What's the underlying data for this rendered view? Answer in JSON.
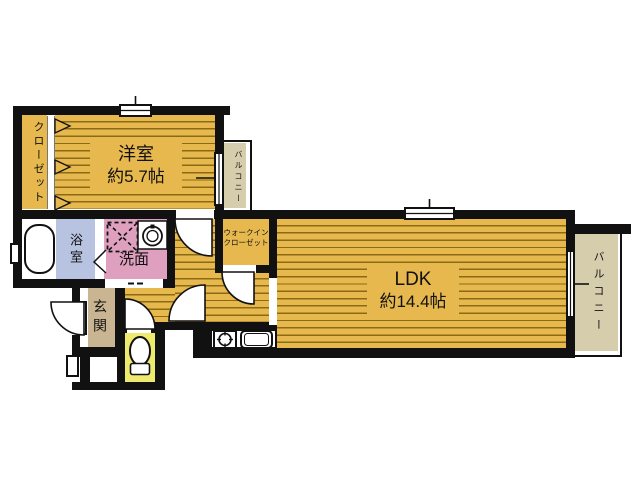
{
  "plan_type": "apartment-floor-plan",
  "colors": {
    "wall": "#111111",
    "room_yellow": "#e6b84d",
    "floor_stripe": "#8a6a14",
    "bath_blue": "#b7c3e0",
    "washroom_pink": "#dfa0c0",
    "toilet_yellow": "#edea6e",
    "entrance_tan": "#c9b592",
    "balcony_tan": "#d6cdad"
  },
  "rooms": {
    "bedroom": {
      "name": "洋室",
      "size": "約5.7帖"
    },
    "closet": {
      "name": "クローゼット"
    },
    "balcony_top": {
      "name": "バルコニー"
    },
    "bath": {
      "name": "浴室"
    },
    "washroom": {
      "name": "洗面"
    },
    "walk_in_closet": {
      "name_line1": "ウォークイン",
      "name_line2": "クローゼット"
    },
    "ldk": {
      "name": "LDK",
      "size": "約14.4帖"
    },
    "balcony_right": {
      "name": "バルコニー"
    },
    "entrance": {
      "name": "玄関"
    }
  },
  "fixtures": {
    "bathtub": "bathtub",
    "washer_pan": "washing-machine-pan",
    "washing_machine": "washing-machine",
    "stove": "gas-stove",
    "kitchen_sink": "kitchen-sink",
    "toilet": "toilet"
  }
}
